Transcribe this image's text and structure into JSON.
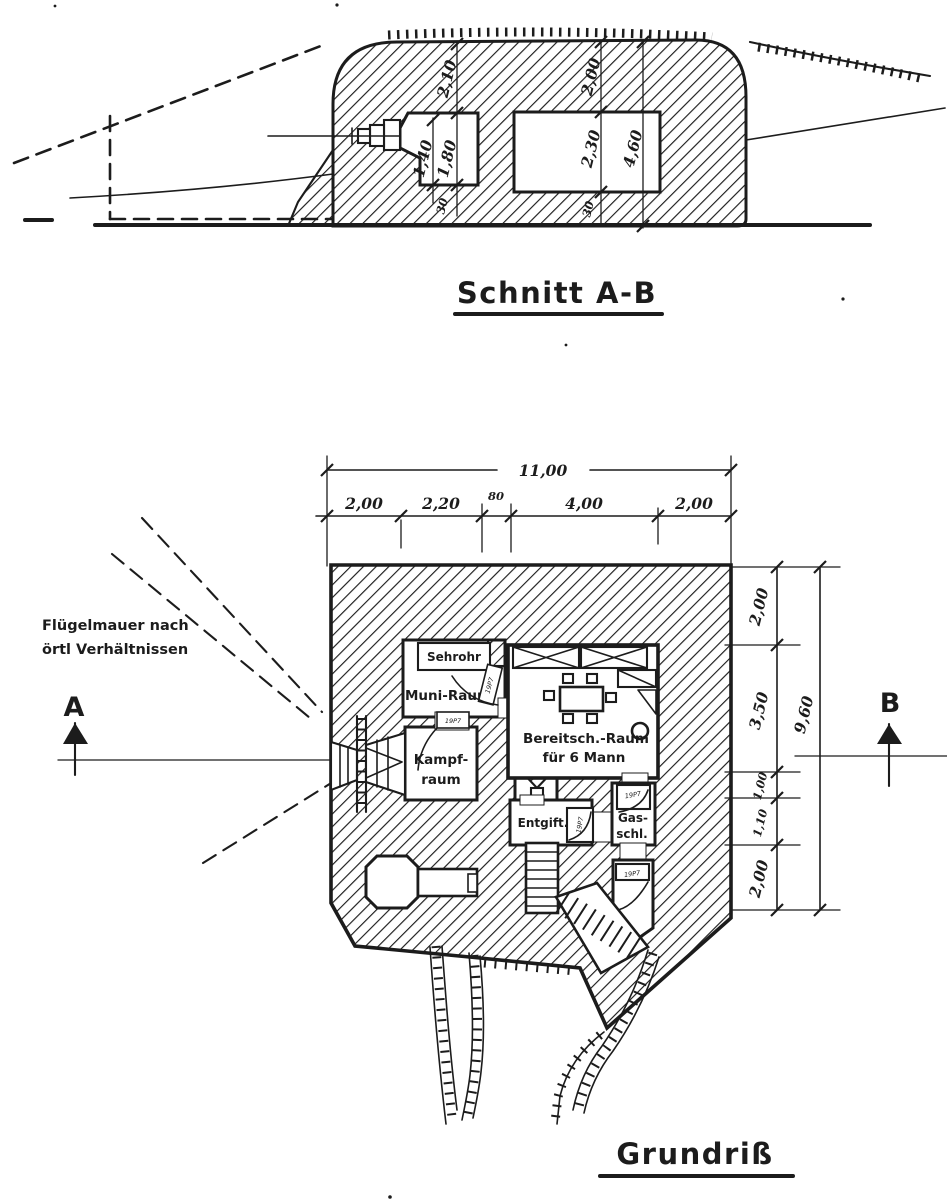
{
  "colors": {
    "ink": "#1c1c1c",
    "paper": "#ffffff"
  },
  "section": {
    "title": "Schnitt A-B",
    "dims": {
      "roof_left": "2,10",
      "roof_right": "2,00",
      "left_room_inner": "1,40",
      "left_room_outer": "1,80",
      "right_room_height": "2,30",
      "right_total": "4,60",
      "floor_left": "30",
      "floor_right": "30"
    }
  },
  "plan": {
    "title": "Grundriß",
    "note_line1": "Flügelmauer nach",
    "note_line2": "örtl Verhältnissen",
    "marker_a": "A",
    "marker_b": "B",
    "dims_top": {
      "overall": "11,00",
      "seg1": "2,00",
      "seg2": "2,20",
      "seg3": "80",
      "seg4": "4,00",
      "seg5": "2,00"
    },
    "dims_right": {
      "overall": "9,60",
      "seg1": "2,00",
      "seg2": "3,50",
      "seg3": "1,00",
      "seg4": "1,10",
      "seg5": "2,00"
    },
    "rooms": {
      "sehrohr": "Sehrohr",
      "muni": "Muni-Raum",
      "bereitsch1": "Bereitsch.-Raum",
      "bereitsch2": "für 6 Mann",
      "kampf1": "Kampf-",
      "kampf2": "raum",
      "entgift": "Entgift.",
      "gas1": "Gas-",
      "gas2": "schl."
    },
    "doors": {
      "muni": "19P7",
      "kampf": "19P7",
      "entgift": "19P7",
      "gas_top": "19P7",
      "gas_exit": "19P7"
    }
  }
}
